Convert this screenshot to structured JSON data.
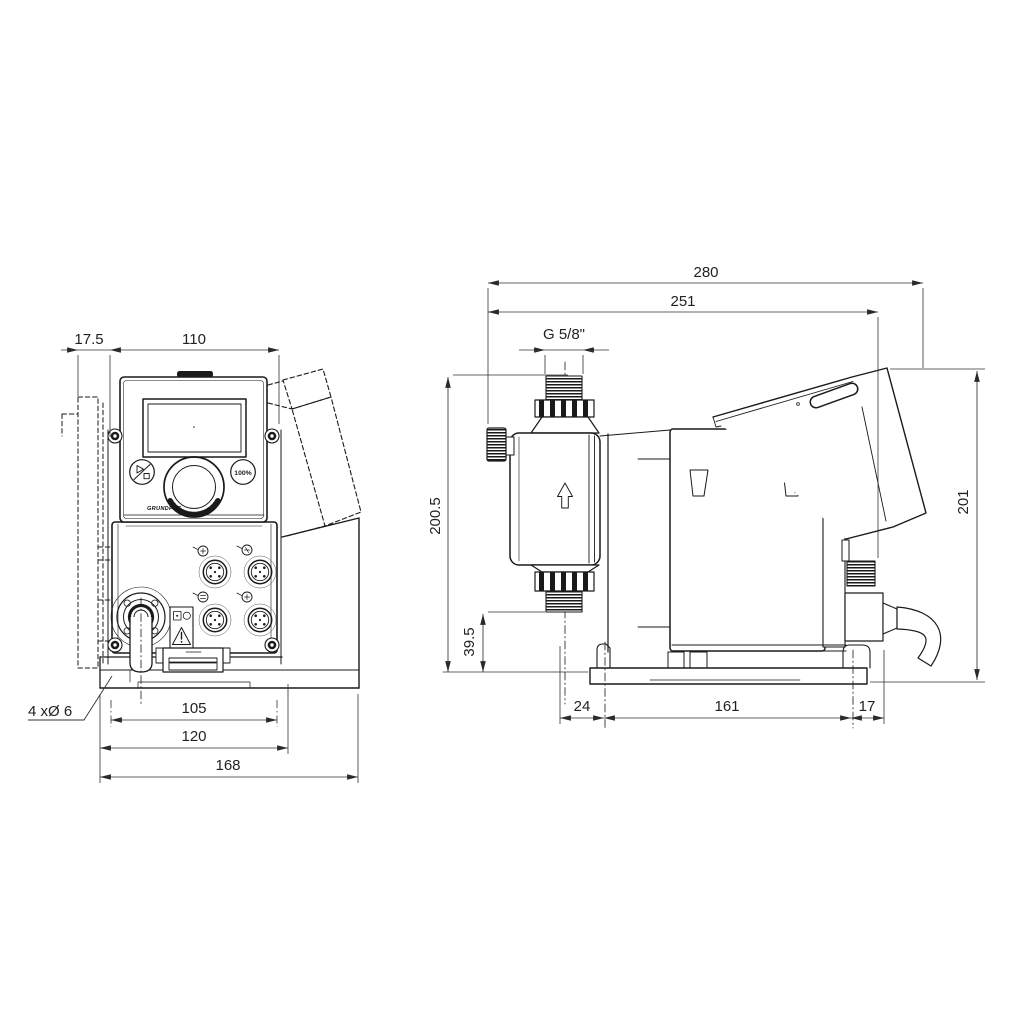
{
  "front_view": {
    "dimensions": {
      "side_offset": "17.5",
      "housing_width": "110",
      "mounting_hole_spacing": "105",
      "mounting_plate_width": "120",
      "total_width": "168",
      "mounting_holes": "4 xØ 6"
    },
    "control_panel": {
      "logo": "GRUNDFOS",
      "capacity_button": "100%"
    }
  },
  "side_view": {
    "dimensions": {
      "total_depth": "280",
      "depth_without_cable": "251",
      "connection_thread": "G 5/8\"",
      "total_height": "200.5",
      "suction_valve_height": "39.5",
      "housing_height": "201",
      "base_front_offset": "24",
      "base_hole_spacing": "161",
      "base_rear_offset": "17"
    }
  }
}
